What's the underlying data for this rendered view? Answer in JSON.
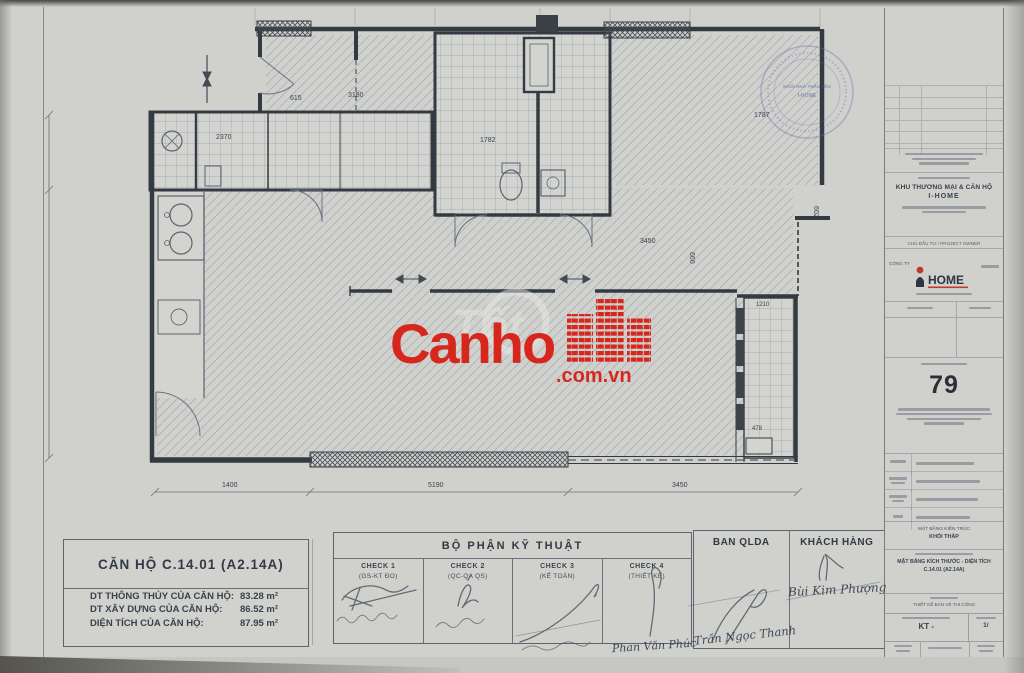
{
  "page": {
    "sheet_bg": "#d0d1cd",
    "accent_red": "#d7271d"
  },
  "plan": {
    "dims": {
      "top_615": "615",
      "hall_3180": "3180",
      "bath_2370": "2370",
      "bath_1782": "1782",
      "mid_3450": "3450",
      "right_1787": "1787",
      "right_602": "602",
      "vert_660": "660",
      "balc_1210": "1210",
      "balc_478": "478",
      "bottom_1400": "1400",
      "bottom_5190": "5190",
      "bottom_3450": "3450"
    }
  },
  "watermark": {
    "brand": "Canho",
    "suffix": ".com.vn",
    "ghost": "Tốt"
  },
  "stamp": {
    "line1": "NGÔI NHÀ THÂN YÊU",
    "line2": "I-HOME"
  },
  "titleblock": {
    "project_line1": "KHU THƯƠNG MẠI & CĂN HỘ",
    "project_line2": "I-HOME",
    "owner_label": "CHỦ ĐẦU TƯ / PROJECT OWNER",
    "company_label": "CÔNG TY",
    "logo_text": "HOME",
    "sheet_no": "79",
    "group_line1": "MẶT BẰNG KIẾN TRÚC",
    "group_line2": "KHỐI THÁP",
    "drawing_title1": "MẶT BẰNG KÍCH THƯỚC - DIỆN TÍCH",
    "drawing_title2": "C.14.01 (A2.14A)",
    "phase_label": "THIẾT KẾ BẢN VẼ THI CÔNG",
    "code_value": "KT -",
    "scale_value": "1/"
  },
  "legend": {
    "title": "CĂN HỘ C.14.01 (A2.14A)",
    "rows": [
      {
        "label": "DT THÔNG THỦY CỦA CĂN HỘ:",
        "value": "83.28 m²"
      },
      {
        "label": "DT XÂY DỰNG CỦA CĂN HỘ:",
        "value": "86.52 m²"
      },
      {
        "label": "DIỆN TÍCH CỦA CĂN HỘ:",
        "value": "87.95 m²"
      }
    ]
  },
  "tech": {
    "title": "BỘ PHẬN KỸ THUẬT",
    "checks": [
      {
        "name": "CHECK 1",
        "role": "(GS-KT ĐO)"
      },
      {
        "name": "CHECK 2",
        "role": "(QC-QA QS)"
      },
      {
        "name": "CHECK 3",
        "role": "(KẾ TOÁN)"
      },
      {
        "name": "CHECK 4",
        "role": "(THIẾT KẾ)"
      }
    ],
    "check4_sign": "Phan Văn Phúc"
  },
  "approval": {
    "qlda_label": "BAN QLDA",
    "qlda_sign": "Trần Ngọc Thanh",
    "customer_label": "KHÁCH HÀNG",
    "customer_sign": "Bùi Kim Phượng"
  }
}
